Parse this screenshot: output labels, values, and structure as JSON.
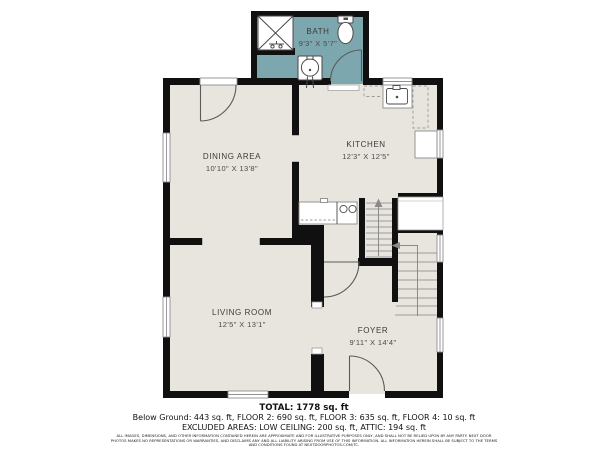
{
  "rooms": {
    "bath": {
      "name": "BATH",
      "dims": "9'3\" X 5'7\""
    },
    "dining": {
      "name": "DINING AREA",
      "dims": "10'10\" X 13'8\""
    },
    "kitchen": {
      "name": "KITCHEN",
      "dims": "12'3\" X 12'5\""
    },
    "living": {
      "name": "LIVING ROOM",
      "dims": "12'5\" X 13'1\""
    },
    "foyer": {
      "name": "FOYER",
      "dims": "9'11\" X 14'4\""
    }
  },
  "summary": {
    "total": "TOTAL: 1778 sq. ft",
    "breakdown": "Below Ground: 443 sq. ft, FLOOR 2: 690 sq. ft, FLOOR 3: 635 sq. ft, FLOOR 4: 10 sq. ft",
    "excluded": "EXCLUDED AREAS: LOW CEILING: 200 sq. ft, ATTIC: 194 sq. ft",
    "disclaimer": "ALL IMAGES, DIMENSIONS, AND OTHER INFORMATION CONTAINED HEREIN ARE APPROXIMATE AND FOR ILLUSTRATIVE PURPOSES ONLY, AND SHALL NOT BE RELIED UPON BY ANY PARTY. NEXT DOOR PHOTOS MAKES NO REPRESENTATIONS OR WARRANTIES, AND DISCLAIMS ANY AND ALL LIABILITY ARISING FROM USE OF THIS INFORMATION. ALL INFORMATION HEREIN SHALL BE SUBJECT TO THE TERMS AND CONDITIONS FOUND AT NEXTDOORPHOTOS.COM/TC."
  },
  "colors": {
    "floor": "#e7e5dd",
    "bath_floor": "#7da7ae",
    "wall": "#101010",
    "fixture_line": "#4a4a4a",
    "tread_line": "#9b9b9b"
  }
}
